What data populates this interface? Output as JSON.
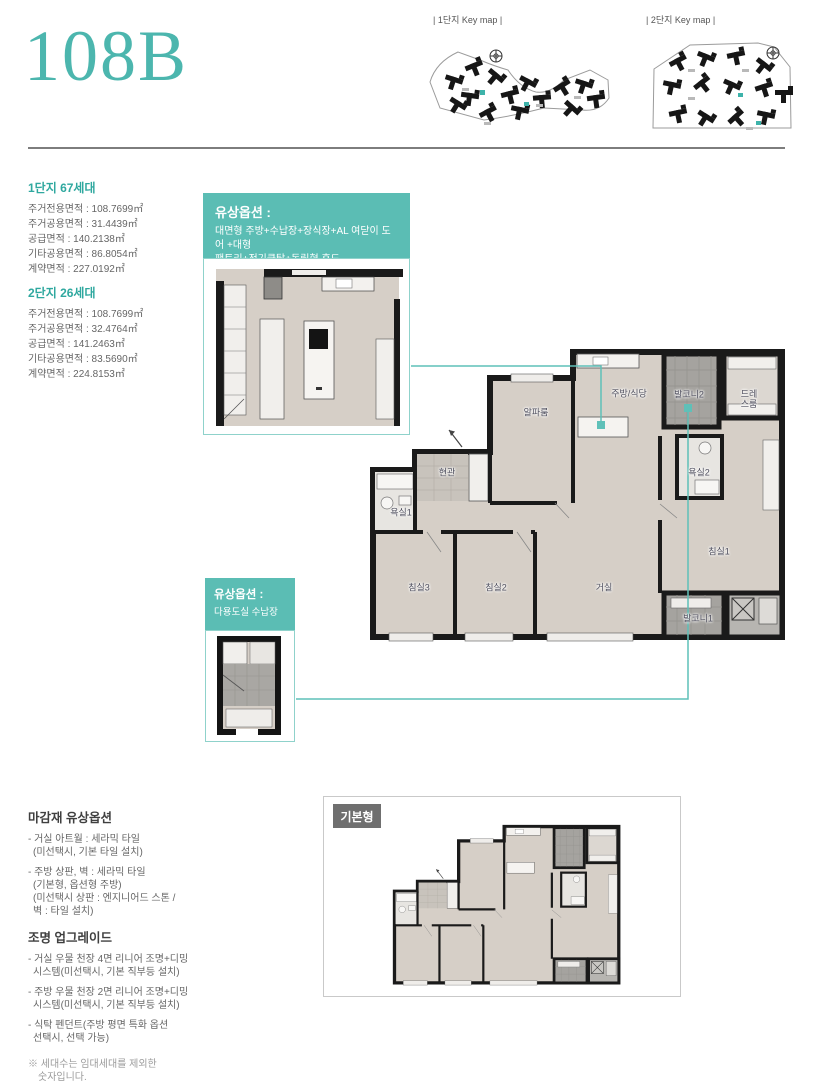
{
  "header": {
    "title": "108B",
    "keymap1_label": "| 1단지 Key map |",
    "keymap2_label": "| 2단지 Key map |"
  },
  "stats": {
    "complex1": {
      "heading": "1단지 67세대",
      "rows": [
        "주거전용면적 : 108.7699㎡",
        "주거공용면적 : 31.4439㎡",
        "공급면적 : 140.2138㎡",
        "기타공용면적 : 86.8054㎡",
        "계약면적 : 227.0192㎡"
      ]
    },
    "complex2": {
      "heading": "2단지 26세대",
      "rows": [
        "주거전용면적 : 108.7699㎡",
        "주거공용면적 : 32.4764㎡",
        "공급면적 : 141.2463㎡",
        "기타공용면적 : 83.5690㎡",
        "계약면적 : 224.8153㎡"
      ]
    }
  },
  "paid_options": {
    "kitchen": {
      "title": "유상옵션 :",
      "line1": "대면형 주방+수납장+장식장+AL 여닫이 도어 +대형",
      "line2": "팬트리+전기쿡탑+독립형 후드"
    },
    "utility": {
      "title": "유상옵션 :",
      "desc": "다용도실 수납장"
    }
  },
  "floor_plan": {
    "rooms": {
      "alpha_room": "알파룸",
      "kitchen_dining": "주방/식당",
      "balcony2": "발코니2",
      "dress_room": "드레스룸",
      "entrance": "현관",
      "bath1": "욕실1",
      "bath2": "욕실2",
      "bedroom3": "침실3",
      "bedroom2": "침실2",
      "living_room": "거실",
      "bedroom1": "침실1",
      "balcony1": "발코니1"
    },
    "basic_type_label": "기본형"
  },
  "finish_options": {
    "heading": "마감재 유상옵션",
    "lines": [
      "- 거실 아트월 : 세라믹 타일",
      "(미선택시, 기본 타일 설치)",
      "- 주방 상판, 벽 : 세라믹 타일",
      "(기본형, 옵션형 주방)",
      "(미선택시 상판 : 엔지니어드 스톤 /",
      "벽 : 타일 설치)"
    ]
  },
  "lighting_options": {
    "heading": "조명 업그레이드",
    "lines": [
      "- 거실 우물 천장 4면 리니어 조명+디밍",
      "시스템(미선택시, 기본 직부등 설치)",
      "- 주방 우물 천장 2면 리니어 조명+디밍",
      "시스템(미선택시, 기본 직부등 설치)",
      "- 식탁 펜던트(주방 평면 특화 옵션",
      "선택시, 선택 가능)"
    ]
  },
  "footnote": {
    "line1": "※ 세대수는 임대세대를 제외한",
    "line2": "숫자입니다."
  },
  "colors": {
    "accent_teal": "#4cb6ae",
    "callout_bg": "#5bbdb4",
    "connector": "#5fc0b8",
    "wall_black": "#1a1a1a"
  }
}
